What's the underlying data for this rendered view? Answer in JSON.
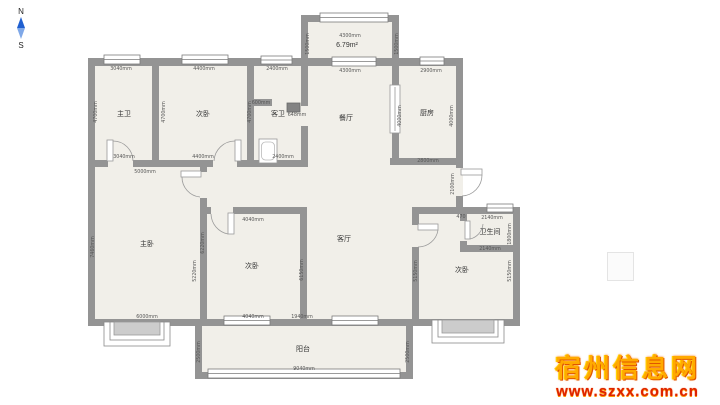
{
  "compass": {
    "north": "N",
    "south": "S"
  },
  "watermark": {
    "title": "宿州信息网",
    "url": "www.szxx.com.cn"
  },
  "floorplan": {
    "area_label": "6.79m²",
    "rooms": [
      {
        "name": "主卫",
        "x": 124,
        "y": 116
      },
      {
        "name": "次卧",
        "x": 203,
        "y": 116
      },
      {
        "name": "客卫",
        "x": 278,
        "y": 116
      },
      {
        "name": "餐厅",
        "x": 346,
        "y": 120
      },
      {
        "name": "厨房",
        "x": 427,
        "y": 115
      },
      {
        "name": "6.79m²",
        "x": 347,
        "y": 47,
        "fs": 8
      },
      {
        "name": "主卧",
        "x": 147,
        "y": 246
      },
      {
        "name": "次卧",
        "x": 252,
        "y": 268
      },
      {
        "name": "客厅",
        "x": 344,
        "y": 241
      },
      {
        "name": "次卧",
        "x": 462,
        "y": 272
      },
      {
        "name": "卫生间",
        "x": 490,
        "y": 234,
        "fs": 6
      },
      {
        "name": "阳台",
        "x": 303,
        "y": 351
      }
    ],
    "dimensions": [
      {
        "t": "3040mm",
        "x": 121,
        "y": 70
      },
      {
        "t": "4400mm",
        "x": 204,
        "y": 70
      },
      {
        "t": "2400mm",
        "x": 277,
        "y": 70
      },
      {
        "t": "4300mm",
        "x": 350,
        "y": 37
      },
      {
        "t": "1500mm",
        "x": 309,
        "y": 44,
        "v": 1
      },
      {
        "t": "1500mm",
        "x": 398,
        "y": 44,
        "v": 1
      },
      {
        "t": "4300mm",
        "x": 350,
        "y": 72
      },
      {
        "t": "2900mm",
        "x": 431,
        "y": 72
      },
      {
        "t": "4700mm",
        "x": 97,
        "y": 112,
        "v": 1
      },
      {
        "t": "4700mm",
        "x": 165,
        "y": 112,
        "v": 1
      },
      {
        "t": "4700mm",
        "x": 251,
        "y": 112,
        "v": 1
      },
      {
        "t": "600mm",
        "x": 261,
        "y": 104
      },
      {
        "t": "648mm",
        "x": 297,
        "y": 116
      },
      {
        "t": "4000mm",
        "x": 401,
        "y": 116,
        "v": 1
      },
      {
        "t": "4000mm",
        "x": 453,
        "y": 116,
        "v": 1
      },
      {
        "t": "2800mm",
        "x": 428,
        "y": 162
      },
      {
        "t": "4400mm",
        "x": 203,
        "y": 158
      },
      {
        "t": "2400mm",
        "x": 283,
        "y": 158
      },
      {
        "t": "3040mm",
        "x": 124,
        "y": 158
      },
      {
        "t": "5000mm",
        "x": 145,
        "y": 173
      },
      {
        "t": "7460mm",
        "x": 94,
        "y": 247,
        "v": 1
      },
      {
        "t": "6220mm",
        "x": 204,
        "y": 243,
        "v": 1
      },
      {
        "t": "5220mm",
        "x": 196,
        "y": 271,
        "v": 1
      },
      {
        "t": "4040mm",
        "x": 253,
        "y": 221
      },
      {
        "t": "6150mm",
        "x": 303,
        "y": 270,
        "v": 1
      },
      {
        "t": "2100mm",
        "x": 454,
        "y": 184,
        "v": 1
      },
      {
        "t": "470",
        "x": 461,
        "y": 218
      },
      {
        "t": "2140mm",
        "x": 492,
        "y": 219
      },
      {
        "t": "1800mm",
        "x": 511,
        "y": 234,
        "v": 1
      },
      {
        "t": "2140mm",
        "x": 490,
        "y": 250
      },
      {
        "t": "5150mm",
        "x": 417,
        "y": 271,
        "v": 1
      },
      {
        "t": "5150mm",
        "x": 511,
        "y": 271,
        "v": 1
      },
      {
        "t": "6000mm",
        "x": 147,
        "y": 318
      },
      {
        "t": "4040mm",
        "x": 253,
        "y": 318
      },
      {
        "t": "1940mm",
        "x": 302,
        "y": 318
      },
      {
        "t": "2500mm",
        "x": 200,
        "y": 352,
        "v": 1
      },
      {
        "t": "2500mm",
        "x": 409,
        "y": 352,
        "v": 1
      },
      {
        "t": "9040mm",
        "x": 304,
        "y": 370
      }
    ]
  }
}
